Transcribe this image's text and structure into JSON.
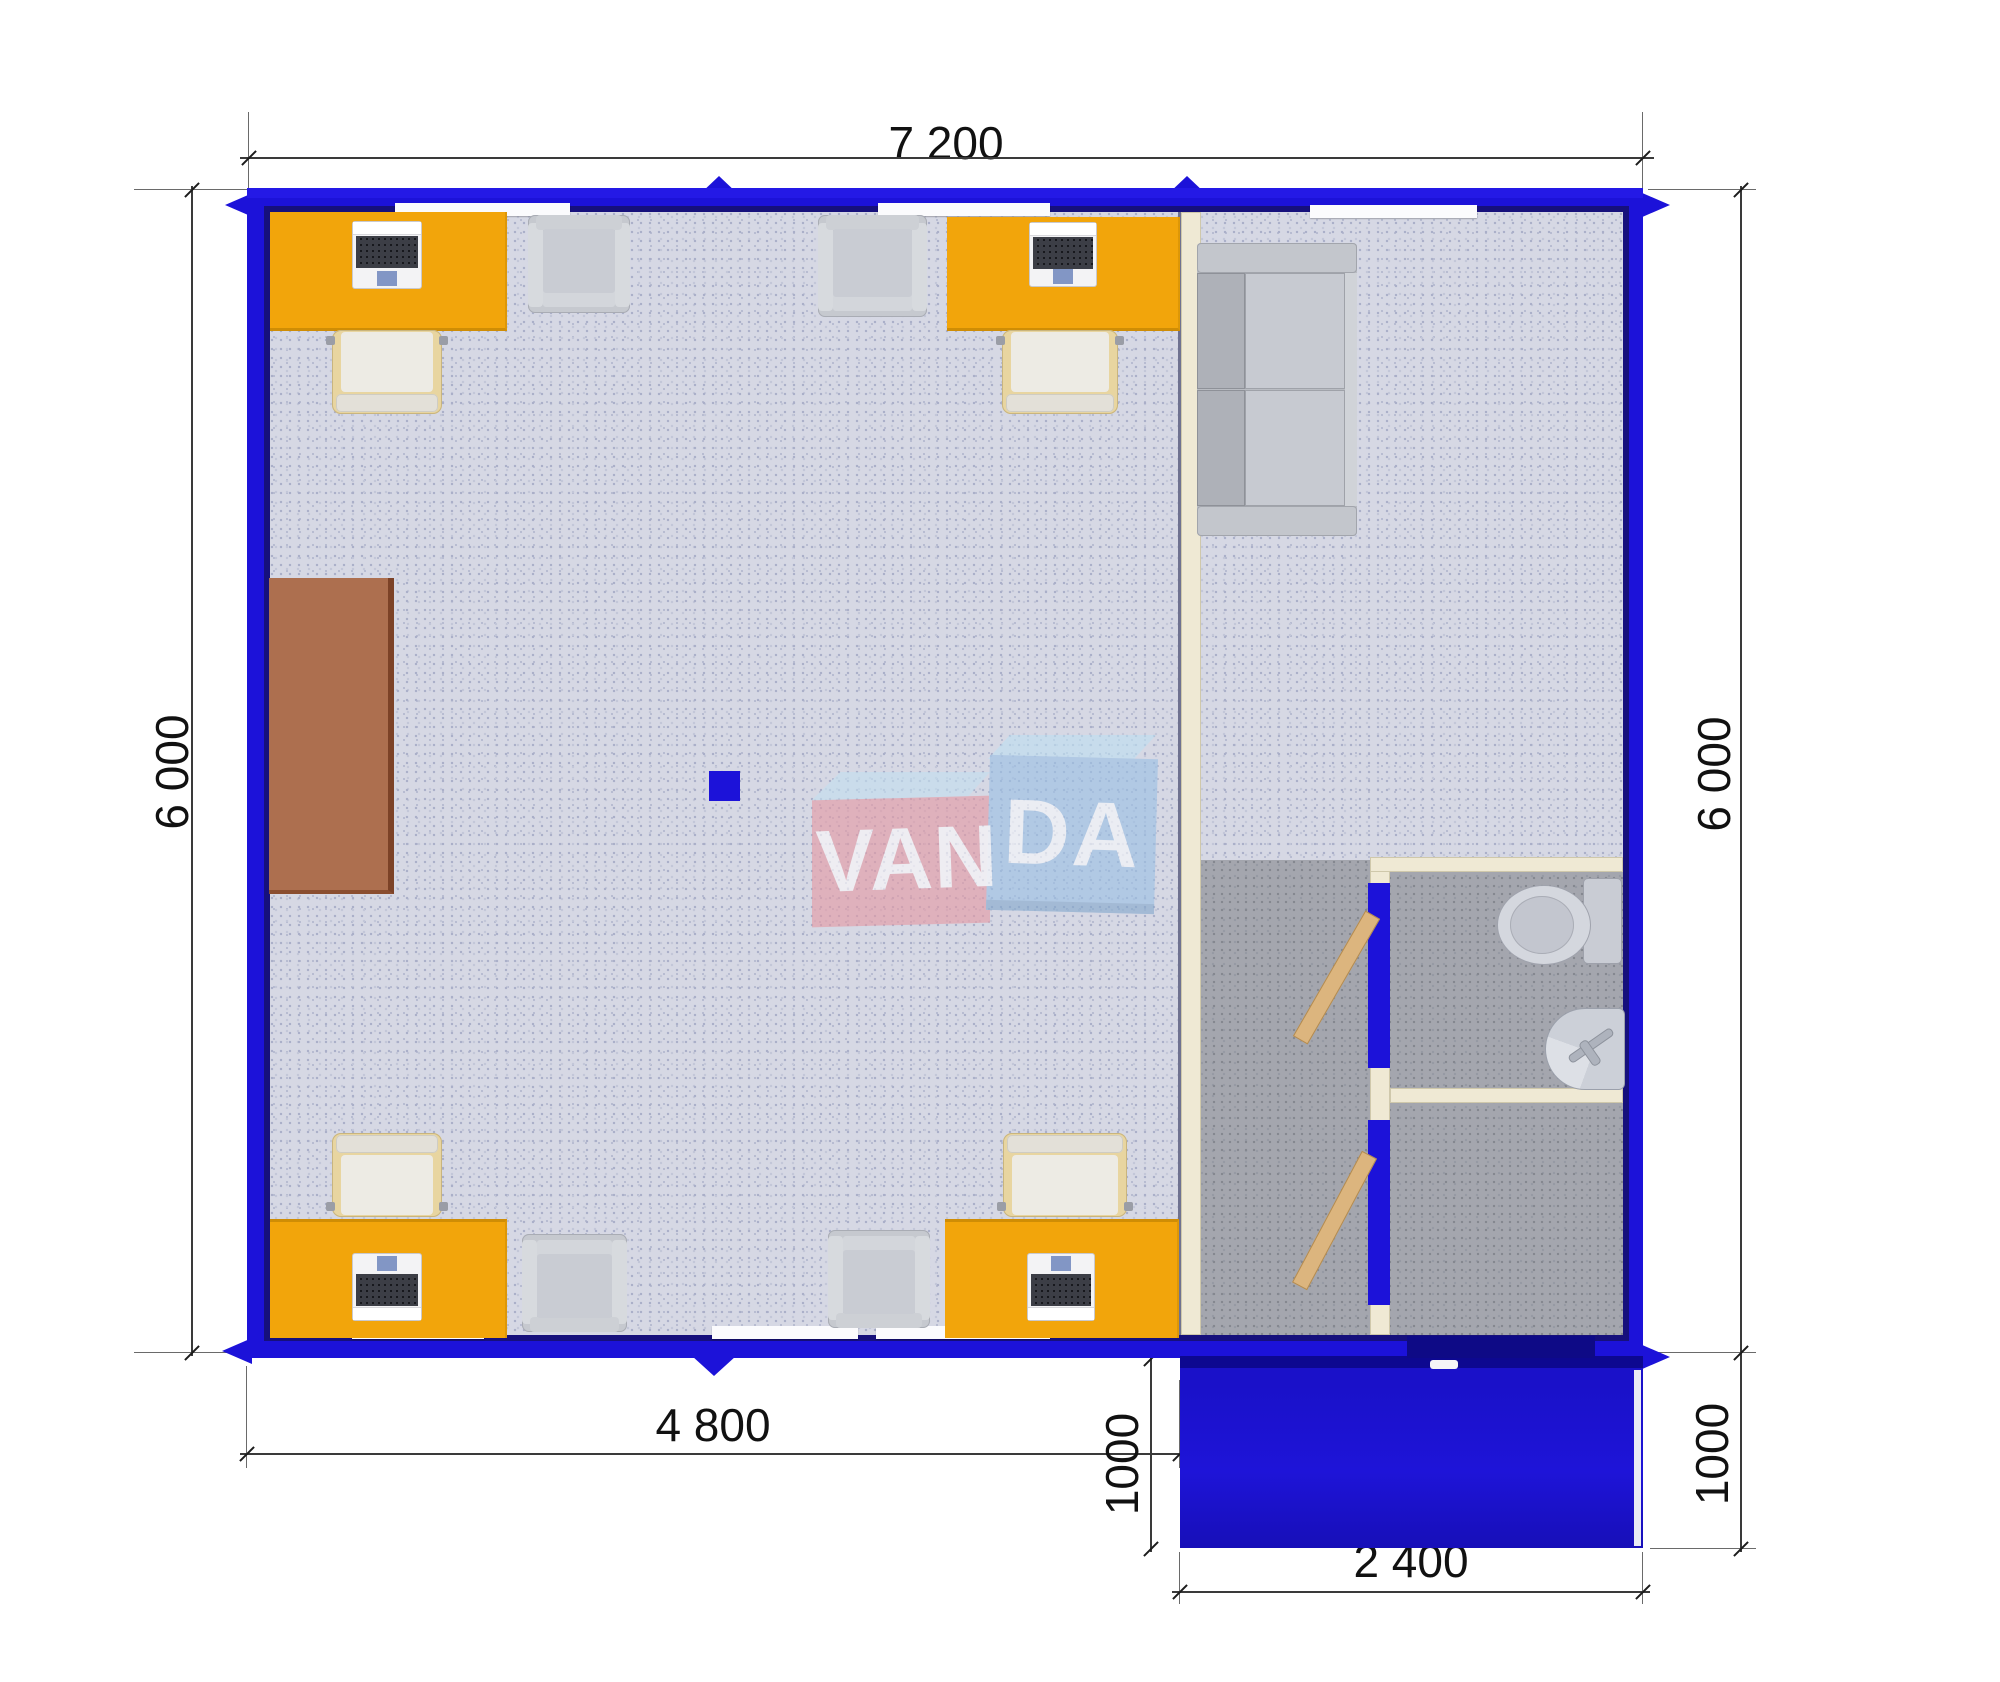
{
  "diagram": {
    "type": "modular-office-floor-plan",
    "brand": "VANDA",
    "logo": {
      "left_box_text": "VAN",
      "right_box_text": "DA",
      "left_box_color": "#e59aa4",
      "right_box_color": "#9cc0e4",
      "text_color": "#ffffff"
    },
    "dimensions": {
      "top_width": "7 200",
      "left_height": "6 000",
      "right_height": "6 000",
      "bottom_left_width": "4 800",
      "porch_depth_left": "1000",
      "porch_depth_right": "1000",
      "porch_width": "2 400"
    },
    "colors": {
      "wall_blue": "#1c12d9",
      "partition_cream": "#efe9d4",
      "floor_office": "#d6d8e4",
      "floor_service": "#a4a6ae",
      "desk_orange": "#f2a50b",
      "cabinet_brown": "#ad6f4f",
      "door_wood": "#dcb57e",
      "porch_blue": "#1a11c9",
      "fixture_gray": "#ccd0d8"
    },
    "furniture_icons": [
      {
        "name": "office-desk-icon",
        "count": 4
      },
      {
        "name": "laptop-icon",
        "count": 4
      },
      {
        "name": "task-chair-icon",
        "count": 4
      },
      {
        "name": "armchair-icon",
        "count": 4
      },
      {
        "name": "cabinet-icon",
        "count": 1
      },
      {
        "name": "sofa-icon",
        "count": 1
      },
      {
        "name": "toilet-icon",
        "count": 1
      },
      {
        "name": "sink-icon",
        "count": 1
      },
      {
        "name": "open-door-icon",
        "count": 2
      },
      {
        "name": "support-column-icon",
        "count": 1
      }
    ]
  }
}
